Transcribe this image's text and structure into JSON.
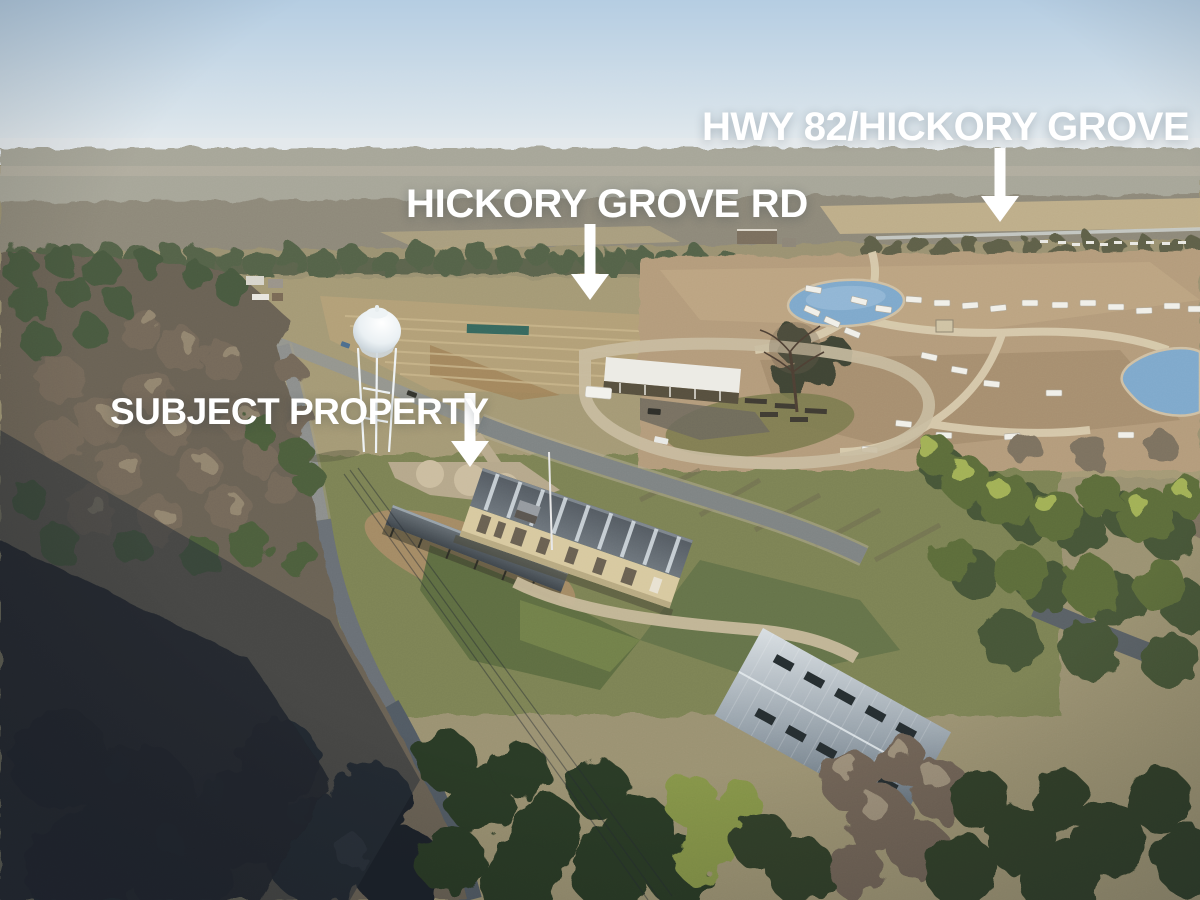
{
  "annotations": {
    "hwy82": {
      "label": "HWY 82/HICKORY GROVE"
    },
    "hickory_grove_rd": {
      "label": "HICKORY GROVE RD"
    },
    "subject_property": {
      "label": "SUBJECT PROPERTY"
    }
  },
  "style": {
    "annotation_color": "#ffffff",
    "sky_top": "#b5cde2",
    "sky_horizon": "#e9edef",
    "pond_blue": "#7fa9cc",
    "roof_tan_wall": "#d8c9a0"
  },
  "scene_landmarks": [
    "water-tower",
    "subject-warehouse",
    "storage-canopy",
    "rv-park",
    "ponds",
    "metal-barn",
    "hickory-grove-rd",
    "hwy-82",
    "winter-forest"
  ]
}
